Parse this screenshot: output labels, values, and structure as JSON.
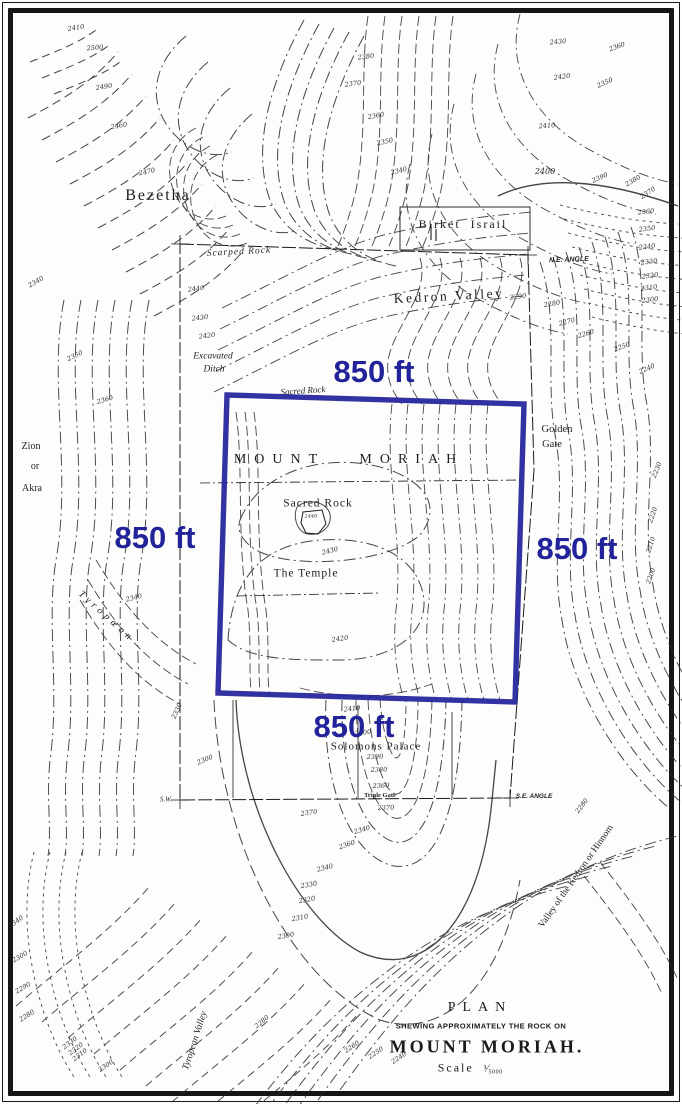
{
  "map": {
    "overlay": {
      "color": "#22229b",
      "side_labels": {
        "top": "850 ft",
        "left": "850 ft",
        "right": "850 ft",
        "bottom": "850 ft"
      }
    },
    "title_block": {
      "plan": "PLAN",
      "subtitle": "SHEWING APPROXIMATELY THE ROCK ON",
      "title": "MOUNT MORIAH.",
      "scale_word": "Scale",
      "scale_value": "¹⁄₅₀₀₀"
    },
    "place_labels": [
      {
        "id": "bezetha",
        "text": "Bezetha",
        "x": 158,
        "y": 196,
        "size": 16,
        "ls": 2
      },
      {
        "id": "birket-israil",
        "text": "Birket  Israil",
        "x": 463,
        "y": 224,
        "size": 12,
        "ls": 2
      },
      {
        "id": "scarped-rock",
        "text": "Scarped Rock",
        "x": 239,
        "y": 253,
        "rot": -3,
        "size": 9.5,
        "ls": 1,
        "it": true
      },
      {
        "id": "ne-angle",
        "text": "N.E. ANGLE",
        "x": 569,
        "y": 260,
        "rot": -2,
        "size": 7,
        "b": true,
        "it": true,
        "f": "sans"
      },
      {
        "id": "kedron-valley",
        "text": "Kedron Valley",
        "x": 449,
        "y": 296,
        "rot": -3,
        "size": 13.5,
        "ls": 2.5
      },
      {
        "id": "excavated-ditch-1",
        "text": "Excavated",
        "x": 213,
        "y": 357,
        "size": 9.5,
        "it": true
      },
      {
        "id": "excavated-ditch-2",
        "text": "Ditch",
        "x": 214,
        "y": 370,
        "size": 9.5,
        "it": true
      },
      {
        "id": "sacred-rock-upper",
        "text": "Sacred Rock",
        "x": 303,
        "y": 391,
        "rot": -4,
        "size": 9,
        "it": true
      },
      {
        "id": "golden-gate-1",
        "text": "Golden",
        "x": 557,
        "y": 430,
        "size": 10.5
      },
      {
        "id": "golden-gate-2",
        "text": "Gate",
        "x": 552,
        "y": 445,
        "size": 10.5
      },
      {
        "id": "zion-1",
        "text": "Zion",
        "x": 31,
        "y": 447,
        "size": 10
      },
      {
        "id": "zion-2",
        "text": "or",
        "x": 35,
        "y": 467,
        "size": 10
      },
      {
        "id": "zion-3",
        "text": "Akra",
        "x": 32,
        "y": 489,
        "size": 10
      },
      {
        "id": "mount-moriah",
        "text": "MOUNT   MORIAH",
        "x": 349,
        "y": 460,
        "size": 14,
        "ls": 8
      },
      {
        "id": "sacred-rock",
        "text": "Sacred Rock",
        "x": 318,
        "y": 504,
        "size": 11.5,
        "ls": 1
      },
      {
        "id": "the-temple",
        "text": "The Temple",
        "x": 306,
        "y": 574,
        "size": 11.5,
        "ls": 1
      },
      {
        "id": "tyropoeon",
        "text": "Tyropœon",
        "x": 106,
        "y": 617,
        "rot": 42,
        "size": 10,
        "ls": 4,
        "it": true
      },
      {
        "id": "solomons-palace",
        "text": "Solomons Palace",
        "x": 376,
        "y": 747,
        "size": 11,
        "ls": 1
      },
      {
        "id": "triple-gate",
        "text": "Triple Gate",
        "x": 380,
        "y": 796,
        "size": 6.5,
        "b": true
      },
      {
        "id": "sw-angle",
        "text": "S.W.",
        "x": 166,
        "y": 800,
        "size": 7,
        "it": true
      },
      {
        "id": "se-angle",
        "text": "S.E. ANGLE",
        "x": 534,
        "y": 797,
        "size": 6.5,
        "b": true,
        "it": true,
        "f": "sans"
      },
      {
        "id": "valley-kedron-hinnom",
        "text": "Valley of the Kedron or Hinnom",
        "x": 577,
        "y": 877,
        "rot": -55,
        "size": 9.5
      },
      {
        "id": "tyropean-valley",
        "text": "Tyropean Valley",
        "x": 196,
        "y": 1041,
        "rot": -72,
        "size": 9.5,
        "it": true
      }
    ],
    "contour_labels": [
      [
        "2410",
        76,
        28,
        -8
      ],
      [
        "2500",
        95,
        48,
        -4
      ],
      [
        "2490",
        104,
        87,
        -8
      ],
      [
        "2460",
        119,
        126,
        -10
      ],
      [
        "2470",
        147,
        172,
        -12
      ],
      [
        "2380",
        366,
        57,
        -6
      ],
      [
        "2370",
        353,
        84,
        -8
      ],
      [
        "2360",
        376,
        116,
        -10
      ],
      [
        "2350",
        385,
        142,
        -12
      ],
      [
        "2340",
        399,
        171,
        -14
      ],
      [
        "2430",
        558,
        42,
        -5
      ],
      [
        "2420",
        562,
        77,
        -7
      ],
      [
        "2410",
        547,
        126,
        -4
      ],
      [
        "2400",
        545,
        172,
        0,
        8
      ],
      [
        "2390",
        600,
        178,
        -24
      ],
      [
        "2380",
        633,
        181,
        -30
      ],
      [
        "2370",
        648,
        193,
        -34
      ],
      [
        "2360",
        646,
        212,
        -6
      ],
      [
        "2350",
        647,
        229,
        -7
      ],
      [
        "2340",
        647,
        247,
        -7
      ],
      [
        "2330",
        649,
        262,
        -7
      ],
      [
        "2320",
        650,
        276,
        -7
      ],
      [
        "2310",
        649,
        288,
        -7
      ],
      [
        "2300",
        650,
        300,
        -7
      ],
      [
        "2290",
        518,
        297,
        -6
      ],
      [
        "2280",
        552,
        304,
        -10
      ],
      [
        "2270",
        567,
        322,
        -14
      ],
      [
        "2260",
        586,
        334,
        -16
      ],
      [
        "2250",
        622,
        347,
        -20
      ],
      [
        "2240",
        647,
        369,
        -24
      ],
      [
        "2230",
        657,
        470,
        -68
      ],
      [
        "2220",
        653,
        515,
        -70
      ],
      [
        "2210",
        651,
        545,
        -70
      ],
      [
        "2200",
        651,
        576,
        -70
      ],
      [
        "2440",
        196,
        289,
        -6
      ],
      [
        "2430",
        200,
        318,
        -6
      ],
      [
        "2420",
        207,
        336,
        -6
      ],
      [
        "2340",
        36,
        282,
        -30
      ],
      [
        "2350",
        75,
        356,
        -26
      ],
      [
        "2360",
        105,
        400,
        -16
      ],
      [
        "2430",
        330,
        551,
        -14
      ],
      [
        "2420",
        340,
        639,
        -8
      ],
      [
        "2440",
        311,
        517,
        0,
        5
      ],
      [
        "2410",
        352,
        709,
        -6
      ],
      [
        "2400",
        363,
        733,
        -8
      ],
      [
        "2390",
        375,
        757,
        -2
      ],
      [
        "2380",
        379,
        770,
        -2
      ],
      [
        "2360",
        381,
        786,
        -2
      ],
      [
        "2370",
        386,
        808,
        -2
      ],
      [
        "2340",
        134,
        598,
        -14
      ],
      [
        "2330",
        177,
        711,
        -66
      ],
      [
        "2300",
        205,
        760,
        -22
      ],
      [
        "2370",
        309,
        813,
        -8
      ],
      [
        "2340",
        362,
        830,
        -16
      ],
      [
        "2360",
        347,
        845,
        -18
      ],
      [
        "2340",
        325,
        868,
        -14
      ],
      [
        "2330",
        309,
        885,
        -10
      ],
      [
        "2320",
        307,
        900,
        -10
      ],
      [
        "2310",
        300,
        918,
        -10
      ],
      [
        "2300",
        286,
        936,
        -10
      ],
      [
        "2340",
        16,
        922,
        -36
      ],
      [
        "2300",
        20,
        957,
        -30
      ],
      [
        "2290",
        23,
        988,
        -30
      ],
      [
        "2280",
        27,
        1016,
        -32
      ],
      [
        "2330",
        70,
        1043,
        -38
      ],
      [
        "2320",
        76,
        1049,
        -38
      ],
      [
        "2310",
        80,
        1055,
        -38
      ],
      [
        "2300",
        106,
        1066,
        -34
      ],
      [
        "2280",
        262,
        1022,
        -40
      ],
      [
        "2260",
        352,
        1047,
        -34
      ],
      [
        "2250",
        376,
        1053,
        -34
      ],
      [
        "2240",
        399,
        1058,
        -34
      ],
      [
        "2280",
        582,
        806,
        -52
      ],
      [
        "2360",
        617,
        47,
        -20
      ],
      [
        "2350",
        605,
        83,
        -24
      ]
    ]
  }
}
